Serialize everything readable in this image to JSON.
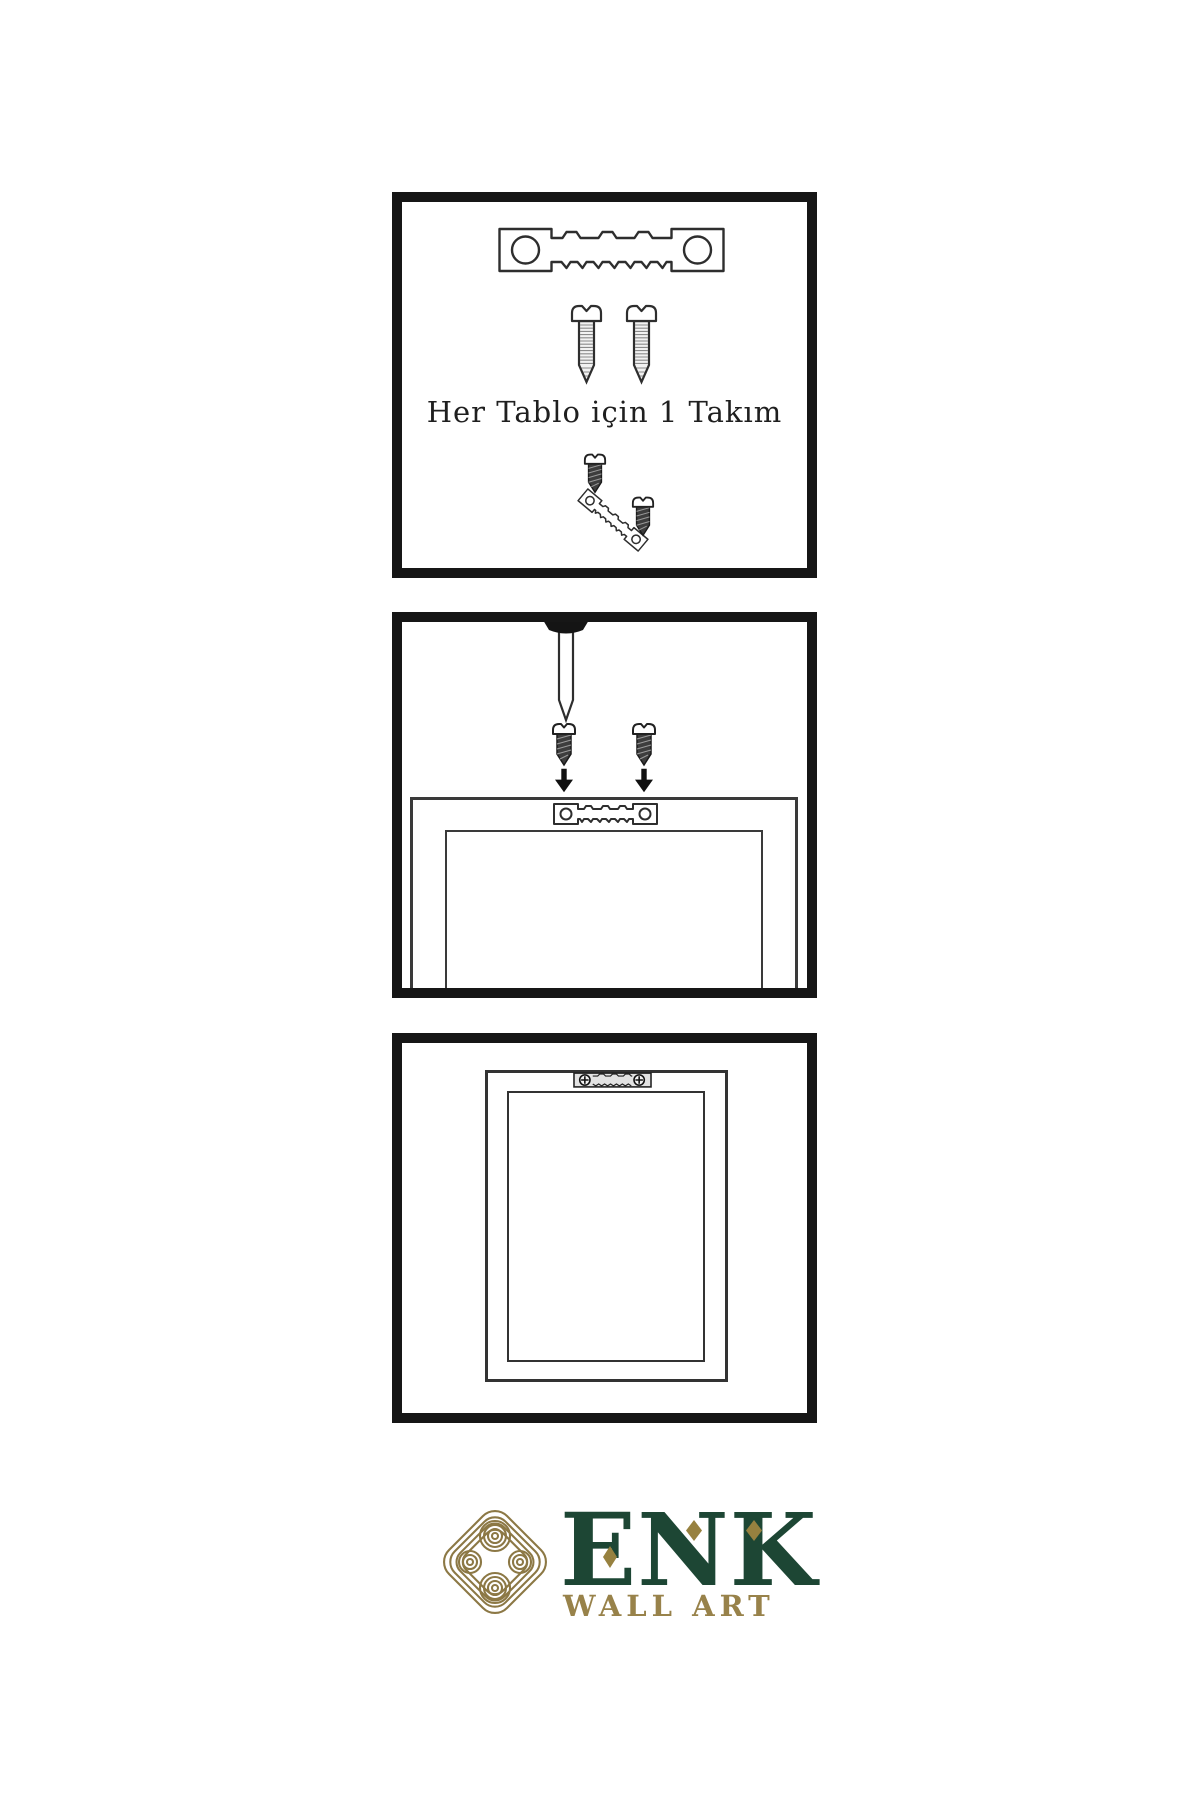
{
  "document": {
    "kind": "wall-art hanging instructions",
    "language": "Turkish"
  },
  "colors": {
    "background": "#ffffff",
    "panel_border": "#161616",
    "line_art": "#2e2e2e",
    "dark_screw_fill": "#3d3d3d",
    "logo_gold": "#8c7845",
    "logo_green": "#1d4634",
    "logo_sub_gold": "#98824a"
  },
  "panels": [
    {
      "name": "hardware-kit",
      "caption": "Her Tablo için 1 Takım"
    },
    {
      "name": "attach-hanger-to-frame",
      "caption": ""
    },
    {
      "name": "hang-frame-on-wall",
      "caption": ""
    }
  ],
  "logo": {
    "brand": "ENK",
    "subtitle": "WALL ART"
  }
}
